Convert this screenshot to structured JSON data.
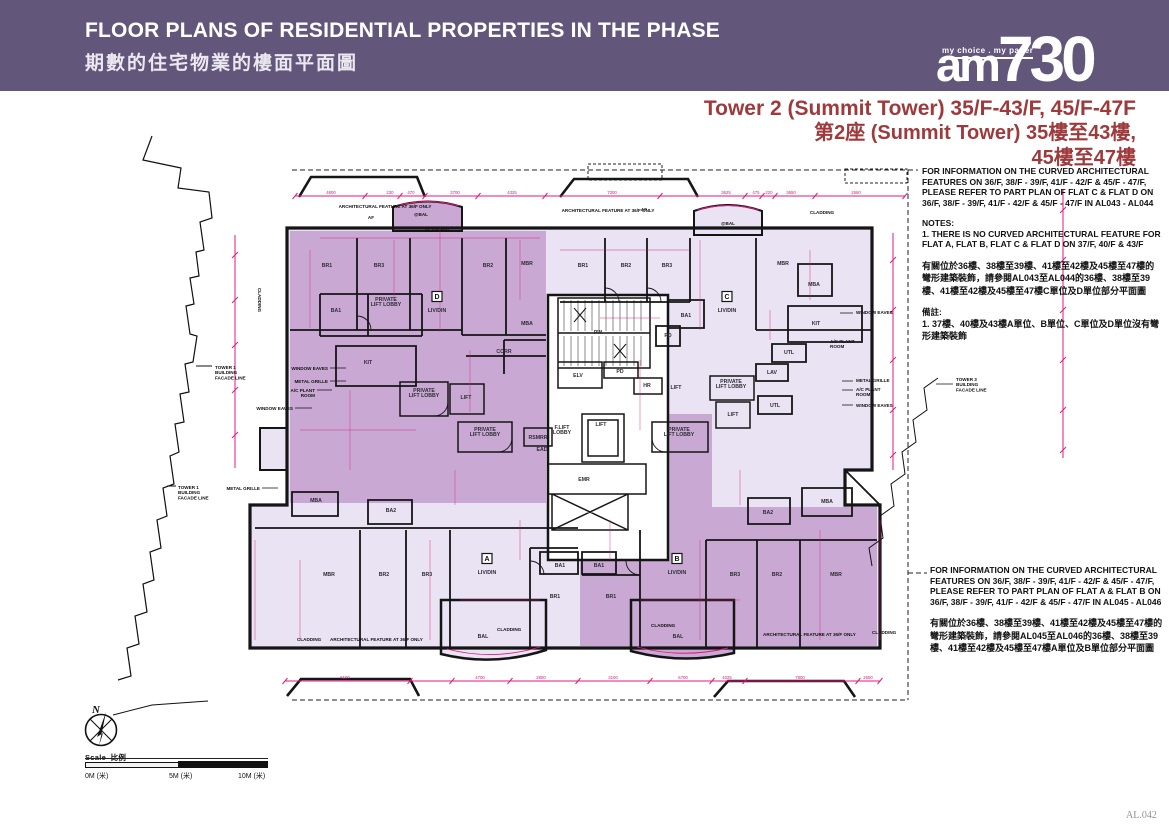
{
  "header": {
    "title_en": "FLOOR PLANS OF RESIDENTIAL PROPERTIES IN THE PHASE",
    "title_zh": "期數的住宅物業的樓面平面圖",
    "bg_color": "#63567b"
  },
  "logo": {
    "tagline": "my choice . my paper",
    "am": "am",
    "n730": "730"
  },
  "plan_title": {
    "line1": "Tower 2 (Summit Tower) 35/F-43/F, 45/F-47F",
    "line2": "第2座 (Summit Tower) 35樓至43樓,",
    "line3": "45樓至47樓",
    "color": "#9e3a3c"
  },
  "notes_top": {
    "p1": "FOR INFORMATION ON THE CURVED ARCHITECTURAL FEATURES ON 36/F, 38/F - 39/F, 41/F - 42/F & 45/F - 47/F, PLEASE REFER TO PART PLAN OF FLAT C & FLAT D ON 36/F, 38/F - 39/F, 41/F - 42/F & 45/F - 47/F IN AL043 - AL044",
    "notes_heading": "NOTES:",
    "n1": "1.   THERE IS NO CURVED ARCHITECTURAL FEATURE FOR FLAT A, FLAT B, FLAT C & FLAT D ON 37/F, 40/F & 43/F",
    "zh1": "有關位於36樓、38樓至39樓、41樓至42樓及45樓至47樓的彎形建築裝飾，請參閱AL043至AL044的36樓、38樓至39樓、41樓至42樓及45樓至47樓C單位及D單位部分平面圖",
    "zh_heading": "備註:",
    "zh_n1": "1.   37樓、40樓及43樓A單位、B單位、C單位及D單位沒有彎形建築裝飾"
  },
  "notes_bottom": {
    "p1": "FOR INFORMATION ON THE CURVED ARCHITECTURAL FEATURES ON 36/F, 38/F - 39/F, 41/F - 42/F & 45/F - 47/F, PLEASE REFER TO PART PLAN OF FLAT A & FLAT B ON 36/F, 38/F - 39/F, 41/F - 42/F & 45/F - 47/F IN AL045 - AL046",
    "zh1": "有關位於36樓、38樓至39樓、41樓至42樓及45樓至47樓的彎形建築裝飾，請參閱AL045至AL046的36樓、38樓至39樓、41樓至42樓及45樓至47樓A單位及B單位部分平面圖"
  },
  "scale_bar": {
    "label_en": "Scale",
    "label_zh": "比例",
    "t0": "0M (米)",
    "t5": "5M (米)",
    "t10": "10M (米)"
  },
  "compass": {
    "label": "N"
  },
  "page_number": "AL.042",
  "colors": {
    "plan_light": "#eae3f4",
    "plan_dark": "#c9a9d4",
    "pink": "#e0187f",
    "wall": "#151515"
  },
  "plan": {
    "rooms": [
      {
        "t": "BR1",
        "x": 327,
        "y": 267
      },
      {
        "t": "BR3",
        "x": 379,
        "y": 267
      },
      {
        "t": "BR2",
        "x": 488,
        "y": 267
      },
      {
        "t": "MBR",
        "x": 527,
        "y": 265
      },
      {
        "t": "BA1",
        "x": 336,
        "y": 312
      },
      {
        "t": "MBA",
        "x": 527,
        "y": 325
      },
      {
        "t": "CORR",
        "x": 504,
        "y": 353
      },
      {
        "t": "KIT",
        "x": 368,
        "y": 364
      },
      {
        "ls": [
          "PRIVATE",
          "LIFT LOBBY"
        ],
        "x": 386,
        "y": 301
      },
      {
        "ls": [
          "PRIVATE",
          "LIFT LOBBY"
        ],
        "x": 424,
        "y": 392
      },
      {
        "t": "LIFT",
        "x": 466,
        "y": 399
      },
      {
        "t": "BR1",
        "x": 583,
        "y": 267
      },
      {
        "t": "BR2",
        "x": 626,
        "y": 267
      },
      {
        "t": "BR3",
        "x": 667,
        "y": 267
      },
      {
        "t": "MBR",
        "x": 783,
        "y": 265
      },
      {
        "t": "MBA",
        "x": 814,
        "y": 286
      },
      {
        "t": "BA1",
        "x": 686,
        "y": 317
      },
      {
        "t": "PD",
        "x": 668,
        "y": 337
      },
      {
        "t": "KIT",
        "x": 816,
        "y": 325
      },
      {
        "t": "UTL",
        "x": 789,
        "y": 354
      },
      {
        "t": "LAV",
        "x": 772,
        "y": 374
      },
      {
        "t": "UTL",
        "x": 775,
        "y": 407
      },
      {
        "ls": [
          "PRIVATE",
          "LIFT LOBBY"
        ],
        "x": 731,
        "y": 383
      },
      {
        "t": "LIFT",
        "x": 676,
        "y": 389
      },
      {
        "t": "LIFT",
        "x": 733,
        "y": 416
      },
      {
        "t": "PW",
        "x": 598,
        "y": 334
      },
      {
        "t": "ELV",
        "x": 578,
        "y": 377
      },
      {
        "t": "PD",
        "x": 620,
        "y": 373
      },
      {
        "t": "HR",
        "x": 647,
        "y": 387
      },
      {
        "t": "RSMRR",
        "x": 538,
        "y": 439
      },
      {
        "t": "EAD",
        "x": 542,
        "y": 451
      },
      {
        "ls": [
          "F.LIFT",
          "LOBBY"
        ],
        "x": 562,
        "y": 429
      },
      {
        "t": "LIFT",
        "x": 601,
        "y": 426
      },
      {
        "t": "EMR",
        "x": 584,
        "y": 481
      },
      {
        "ls": [
          "PRIVATE",
          "LIFT LOBBY"
        ],
        "x": 485,
        "y": 431
      },
      {
        "ls": [
          "PRIVATE",
          "LIFT LOBBY"
        ],
        "x": 679,
        "y": 431
      },
      {
        "t": "MBA",
        "x": 316,
        "y": 502
      },
      {
        "t": "BA2",
        "x": 391,
        "y": 512
      },
      {
        "t": "MBR",
        "x": 329,
        "y": 576
      },
      {
        "t": "BR2",
        "x": 384,
        "y": 576
      },
      {
        "t": "BR3",
        "x": 427,
        "y": 576
      },
      {
        "t": "BA1",
        "x": 560,
        "y": 567
      },
      {
        "t": "BR1",
        "x": 555,
        "y": 598
      },
      {
        "t": "BAL",
        "x": 483,
        "y": 638
      },
      {
        "t": "BA1",
        "x": 599,
        "y": 567
      },
      {
        "t": "BR1",
        "x": 611,
        "y": 598
      },
      {
        "t": "BA2",
        "x": 768,
        "y": 514
      },
      {
        "t": "MBA",
        "x": 827,
        "y": 503
      },
      {
        "t": "BR3",
        "x": 735,
        "y": 576
      },
      {
        "t": "BR2",
        "x": 777,
        "y": 576
      },
      {
        "t": "MBR",
        "x": 836,
        "y": 576
      },
      {
        "t": "BAL",
        "x": 678,
        "y": 638
      }
    ],
    "flat_markers": [
      {
        "letter": "D",
        "label": "LIV/DIN",
        "x": 437,
        "y": 299
      },
      {
        "letter": "C",
        "label": "LIV/DIN",
        "x": 727,
        "y": 299
      },
      {
        "letter": "A",
        "label": "LIV/DIN",
        "x": 487,
        "y": 561
      },
      {
        "letter": "B",
        "label": "LIV/DIN",
        "x": 677,
        "y": 561
      }
    ],
    "annotations": [
      {
        "t": "ARCHITECTURAL FEATURE AT 36/F ONLY",
        "x": 385,
        "y": 208,
        "a": "m"
      },
      {
        "t": "ARCHITECTURAL FEATURE AT 36/F ONLY",
        "x": 608,
        "y": 212,
        "a": "m"
      },
      {
        "t": "@BAL",
        "x": 421,
        "y": 216,
        "a": "m"
      },
      {
        "t": "CLADDING",
        "x": 437,
        "y": 232,
        "a": "m"
      },
      {
        "t": "@BAL",
        "x": 728,
        "y": 225,
        "a": "m"
      },
      {
        "t": "CLADDING",
        "x": 822,
        "y": 214,
        "a": "m"
      },
      {
        "t": "AF",
        "x": 374,
        "y": 219,
        "a": "e"
      },
      {
        "t": "AF",
        "x": 647,
        "y": 211,
        "a": "e"
      },
      {
        "t": "CLADDING",
        "x": 258,
        "y": 300,
        "a": "m",
        "v": 1
      },
      {
        "t": "WINDOW EAVES",
        "x": 328,
        "y": 370,
        "a": "e"
      },
      {
        "t": "METAL GRILLE",
        "x": 328,
        "y": 383,
        "a": "e"
      },
      {
        "ls": [
          "A/C PLANT",
          "ROOM"
        ],
        "x": 315,
        "y": 392,
        "a": "e"
      },
      {
        "t": "WINDOW EAVES",
        "x": 293,
        "y": 410,
        "a": "e"
      },
      {
        "t": "METAL GRILLE",
        "x": 260,
        "y": 490,
        "a": "e"
      },
      {
        "ls": [
          "TOWER 1",
          "BUILDING",
          "FACADE LINE"
        ],
        "x": 215,
        "y": 369,
        "a": "s"
      },
      {
        "ls": [
          "TOWER 1",
          "BUILDING",
          "FACADE LINE"
        ],
        "x": 178,
        "y": 489,
        "a": "s"
      },
      {
        "t": "WINDOW EAVES",
        "x": 856,
        "y": 314,
        "a": "s"
      },
      {
        "t": "METAL GRILLE",
        "x": 856,
        "y": 382,
        "a": "s"
      },
      {
        "ls": [
          "A/C PLANT",
          "ROOM"
        ],
        "x": 856,
        "y": 391,
        "a": "s"
      },
      {
        "t": "WINDOW EAVES",
        "x": 856,
        "y": 407,
        "a": "s"
      },
      {
        "ls": [
          "A/C PLANT",
          "ROOM"
        ],
        "x": 830,
        "y": 343,
        "a": "s"
      },
      {
        "ls": [
          "TOWER 3",
          "BUILDING",
          "FACADE LINE"
        ],
        "x": 956,
        "y": 381,
        "a": "s"
      },
      {
        "t": "CLADDING",
        "x": 297,
        "y": 641,
        "a": "s"
      },
      {
        "t": "ARCHITECTURAL FEATURE AT 36/F ONLY",
        "x": 330,
        "y": 641,
        "a": "s"
      },
      {
        "t": "CLADDING",
        "x": 497,
        "y": 631,
        "a": "s"
      },
      {
        "t": "CLADDING",
        "x": 651,
        "y": 627,
        "a": "s"
      },
      {
        "t": "ARCHITECTURAL FEATURE AT 36/F ONLY",
        "x": 763,
        "y": 636,
        "a": "s"
      },
      {
        "t": "CLADDING",
        "x": 872,
        "y": 634,
        "a": "s"
      }
    ],
    "dims_top": {
      "y": 194,
      "values": [
        {
          "t": "4800",
          "x": 331
        },
        {
          "t": "230",
          "x": 390
        },
        {
          "t": "470",
          "x": 411
        },
        {
          "t": "3700",
          "x": 455
        },
        {
          "t": "4325",
          "x": 512
        },
        {
          "t": "7300",
          "x": 612
        },
        {
          "t": "3625",
          "x": 726
        },
        {
          "t": "475",
          "x": 756
        },
        {
          "t": "220",
          "x": 769
        },
        {
          "t": "3650",
          "x": 791
        },
        {
          "t": "2660",
          "x": 856
        }
      ]
    },
    "dims_bottom": {
      "y": 679,
      "values": [
        {
          "t": "6100",
          "x": 345
        },
        {
          "t": "4700",
          "x": 480
        },
        {
          "t": "2800",
          "x": 541
        },
        {
          "t": "3100",
          "x": 613
        },
        {
          "t": "6700",
          "x": 683
        },
        {
          "t": "4025",
          "x": 727
        },
        {
          "t": "7800",
          "x": 800
        },
        {
          "t": "2650",
          "x": 868
        }
      ]
    }
  }
}
